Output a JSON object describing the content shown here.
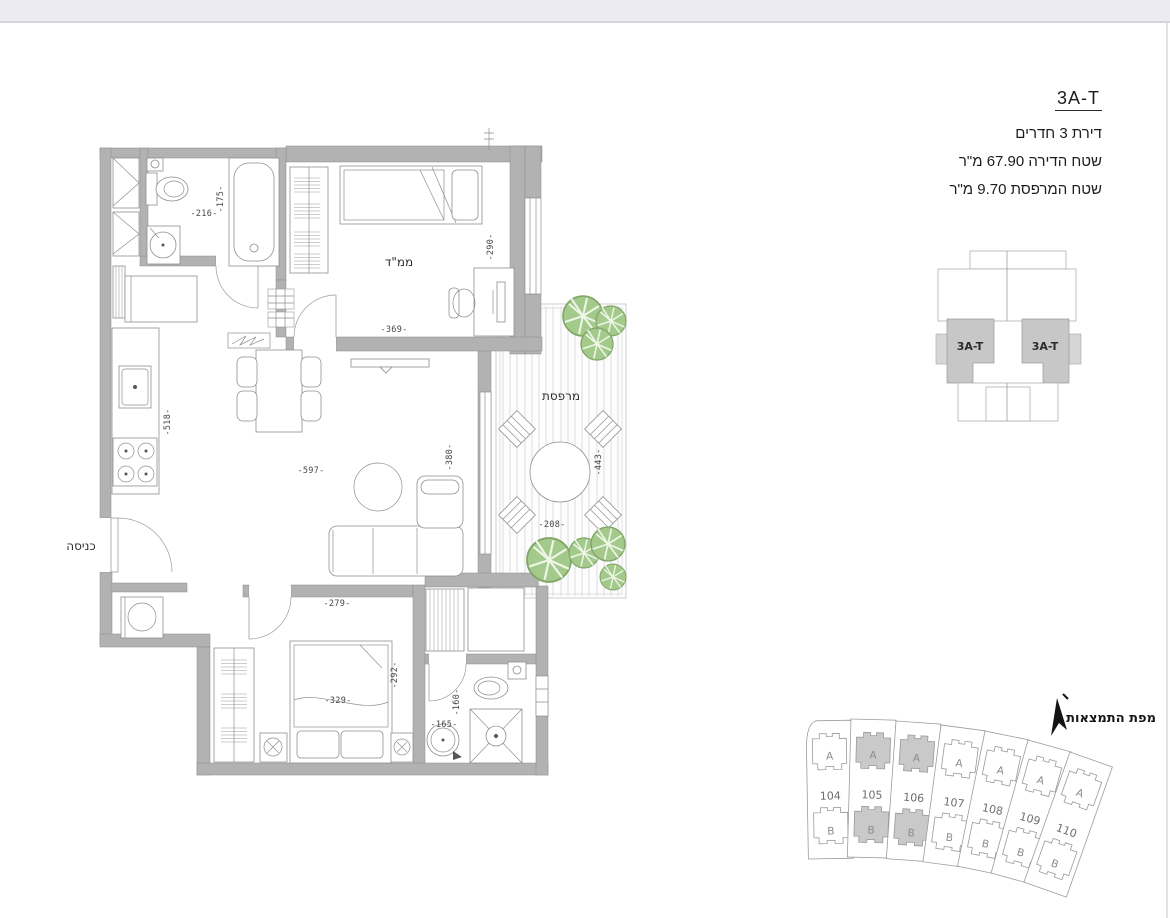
{
  "header": {
    "unit_code": "3A-T",
    "apartment_type": "דירת 3 חדרים",
    "apartment_area": "שטח הדירה 67.90 מ\"ר",
    "balcony_area": "שטח המרפסת 9.70 מ\"ר"
  },
  "floor_plan": {
    "labels": {
      "safe_room": "ממ\"ד",
      "balcony": "מרפסת",
      "entrance": "כניסה"
    },
    "dims": {
      "bath_width": "-216-",
      "bath_height": "-175-",
      "mamad_width": "-369-",
      "mamad_height": "-290-",
      "kitchen_height": "-518-",
      "living_width": "-597-",
      "living_height": "-380-",
      "balcony_height": "-443-",
      "balcony_width": "-208-",
      "bedroom_top_width": "-279-",
      "bedroom_width": "-329-",
      "bedroom_height": "-292-",
      "bath2_width": "-165-",
      "bath2_height": "-160-"
    }
  },
  "key_diagram": {
    "left_unit_label": "3A-T",
    "right_unit_label": "3A-T"
  },
  "site_map": {
    "title": "מפת התמצאות",
    "highlight_color": "#c9c9c9",
    "plots": [
      {
        "number": "104",
        "a": "A",
        "b": "B",
        "highlighted": false,
        "fill_a": "#ffffff",
        "fill_b": "#ffffff"
      },
      {
        "number": "105",
        "a": "A",
        "b": "B",
        "highlighted": true,
        "fill_a": "#c9c9c9",
        "fill_b": "#c9c9c9"
      },
      {
        "number": "106",
        "a": "A",
        "b": "B",
        "highlighted": true,
        "fill_a": "#c9c9c9",
        "fill_b": "#c9c9c9"
      },
      {
        "number": "107",
        "a": "A",
        "b": "B",
        "highlighted": false,
        "fill_a": "#ffffff",
        "fill_b": "#ffffff"
      },
      {
        "number": "108",
        "a": "A",
        "b": "B",
        "highlighted": false,
        "fill_a": "#ffffff",
        "fill_b": "#ffffff"
      },
      {
        "number": "109",
        "a": "A",
        "b": "B",
        "highlighted": false,
        "fill_a": "#ffffff",
        "fill_b": "#ffffff"
      },
      {
        "number": "110",
        "a": "A",
        "b": "B",
        "highlighted": false,
        "fill_a": "#ffffff",
        "fill_b": "#ffffff"
      }
    ]
  },
  "colors": {
    "wall": "#b2b2b2",
    "plant": "#a3ca8b",
    "highlight": "#c9c9c9"
  }
}
